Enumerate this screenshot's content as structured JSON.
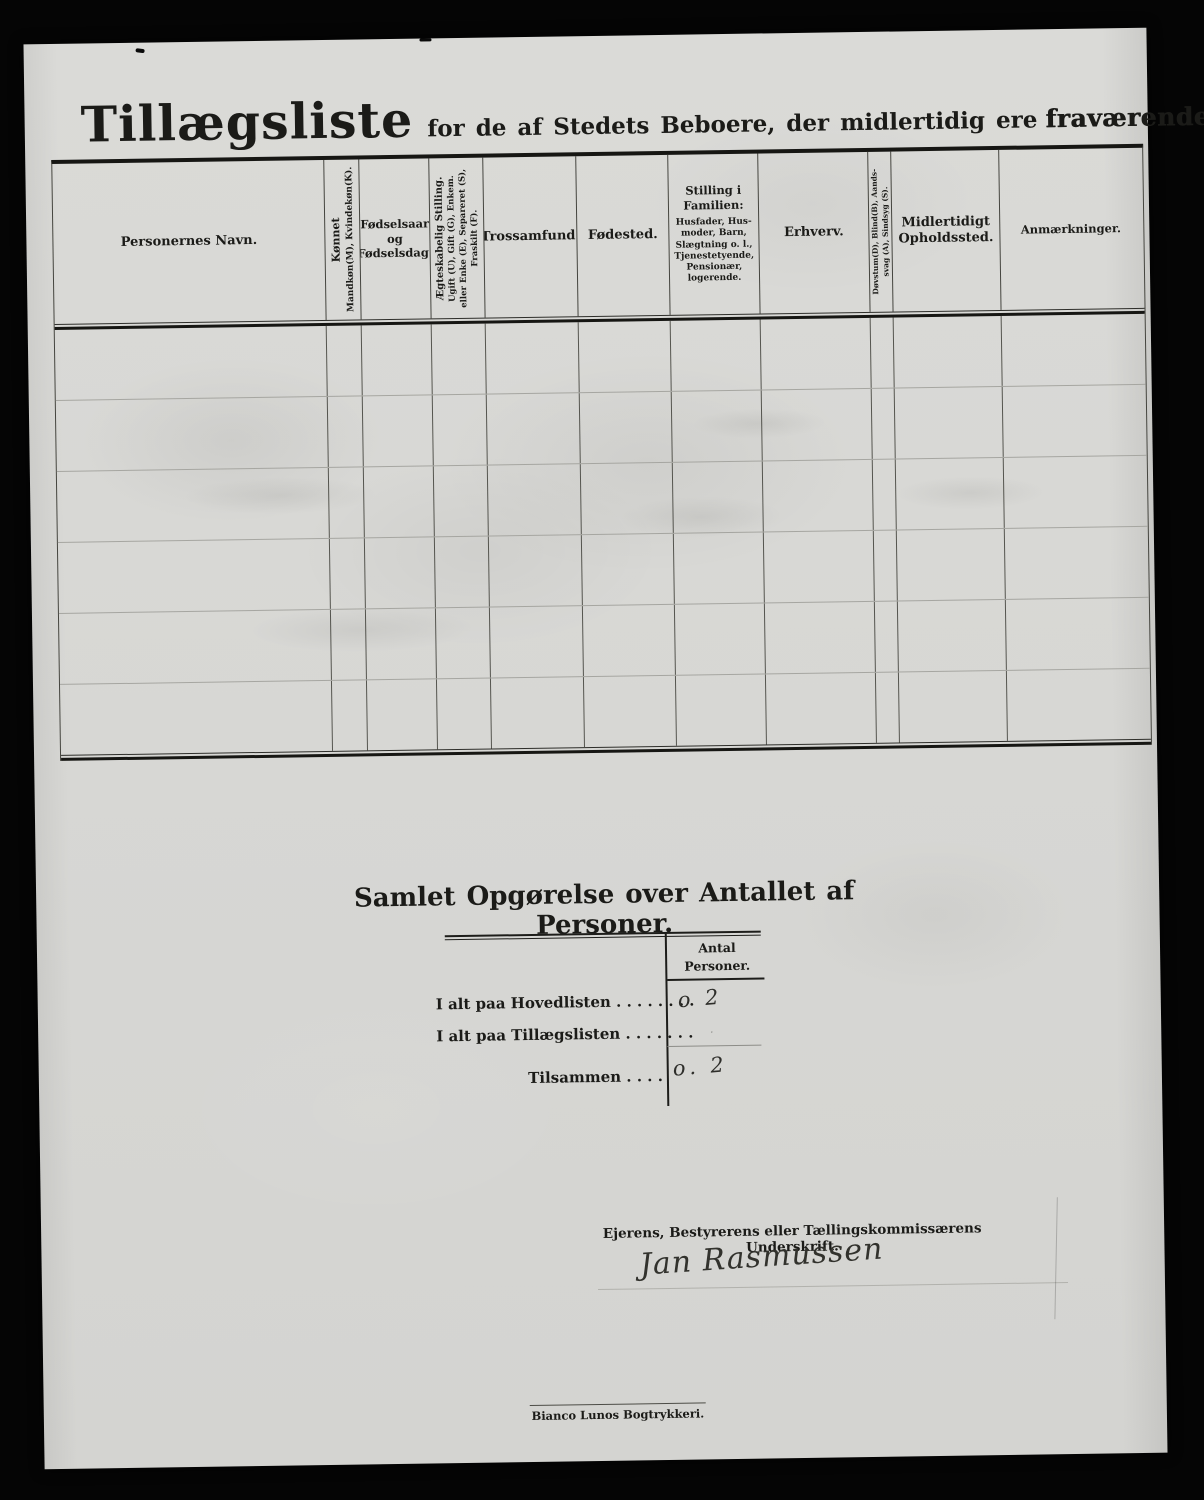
{
  "colors": {
    "background": "#050505",
    "paper": "#d6d6d3",
    "ink": "#1b1b18",
    "handwriting": "#2e2e2a"
  },
  "title": {
    "main": "Tillægsliste",
    "rest": "for de af Stedets Beboere, der midlertidig ere",
    "emphasis": "fraværende."
  },
  "table": {
    "blank_row_count": 6,
    "columns": [
      {
        "id": "personernes-navn",
        "lines": [
          "Personernes Navn."
        ]
      },
      {
        "id": "koennet",
        "lines": [
          "Kønnet",
          "Mandkøn(M), Kvindekøn(K)."
        ]
      },
      {
        "id": "foedselsaar-og-foedselsdag",
        "lines": [
          "Fødselsaar",
          "og",
          "Fødselsdag."
        ]
      },
      {
        "id": "aegteskabelig-stilling",
        "lines": [
          "Ægteskabelig Stilling.",
          "Ugift (U), Gift (G), Enkem.",
          "eller Enke (E), Separeret (S),",
          "Fraskilt (F)."
        ]
      },
      {
        "id": "trossamfund",
        "lines": [
          "Trossamfund."
        ]
      },
      {
        "id": "foedested",
        "lines": [
          "Fødested."
        ]
      },
      {
        "id": "stilling-i-familien",
        "lines": [
          "Stilling i",
          "Familien:"
        ],
        "sub": "Husfader, Hus-moder, Barn, Slægtning o. l., Tjenestetyende, Pensionær, logerende."
      },
      {
        "id": "erhverv",
        "lines": [
          "Erhverv."
        ]
      },
      {
        "id": "doevstum-blind-aandssvag-sindsyg",
        "lines": [
          "Døvstum(D), Blind(B), Aands-",
          "svag (A), Sindsyg (S)."
        ]
      },
      {
        "id": "midlertidigt-opholdssted",
        "lines": [
          "Midlertidigt",
          "Opholdssted."
        ]
      },
      {
        "id": "anmaerkninger",
        "lines": [
          "Anmærkninger."
        ]
      }
    ]
  },
  "summary": {
    "heading": "Samlet Opgørelse over Antallet af Personer.",
    "column_header": {
      "line1": "Antal",
      "line2": "Personer."
    },
    "rows": [
      {
        "label": "I alt paa Hovedlisten",
        "dots": " . . . . . . . .",
        "value": "o 2"
      },
      {
        "label": "I alt paa Tillægslisten",
        "dots": " . . . . . . .",
        "value": "·"
      },
      {
        "label": "Tilsammen",
        "dots": " . . . .",
        "value": "o. 2"
      }
    ]
  },
  "signature": {
    "label": "Ejerens, Bestyrerens eller Tællingskommissærens Underskrift.",
    "name": "Jan Rasmussen"
  },
  "footer": {
    "printer": "Bianco Lunos Bogtrykkeri."
  }
}
